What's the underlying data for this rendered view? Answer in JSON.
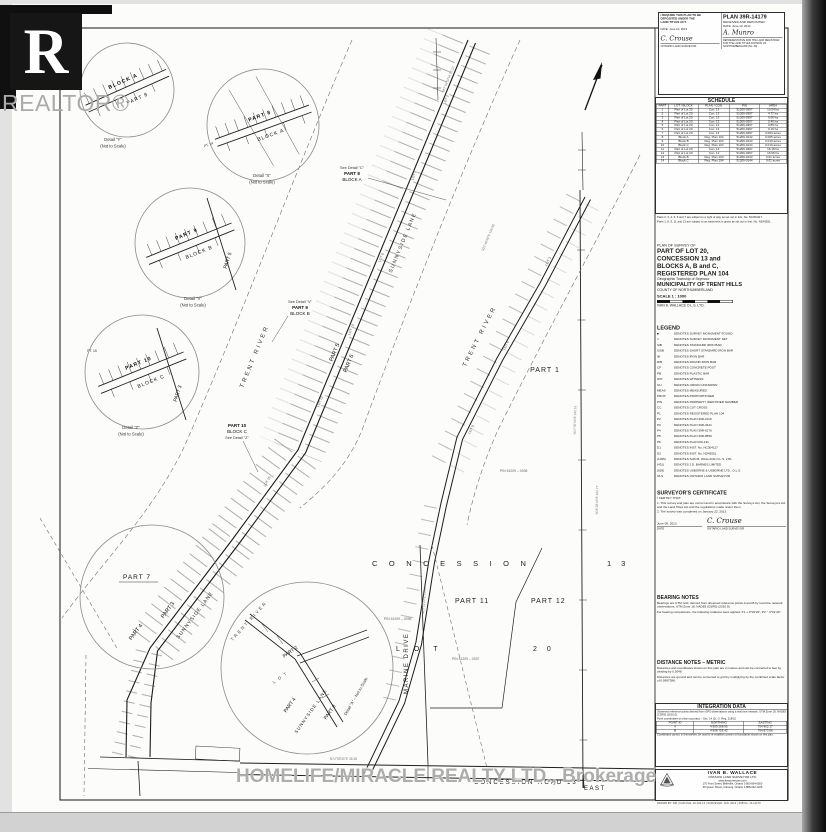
{
  "scan": {
    "realtor_r": "R",
    "realtor_wordmark": "REALTOR®"
  },
  "watermark": {
    "text": "HOMELIFE/MIRACLE REALTY LTD., Brokerage"
  },
  "deposit": {
    "require1": "I REQUIRE THIS PLAN TO BE",
    "require2": "DEPOSITED UNDER THE",
    "require3": "LAND TITLES ACT.",
    "date_left": "DATE:  June 10, 2013",
    "sig_left": "C. Crouse",
    "sig_left_sub": "ONTARIO LAND SURVEYOR",
    "plan_no": "PLAN 39R-14179",
    "received": "RECEIVED AND DEPOSITED",
    "date_right": "DATE:  June 13, 2013",
    "sig_right": "A. Munro",
    "rep_note": "REPRESENTATIVE FOR THE LAND REGISTRAR FOR THE LAND TITLES DIVISION OF NORTHUMBERLAND (No. 39)"
  },
  "schedule": {
    "title": "SCHEDULE",
    "columns": [
      "PART",
      "LOT / BLOCK",
      "PLAN / CON.",
      "PIN",
      "AREA"
    ],
    "rows": [
      {
        "p": "1",
        "lb": "Part of Lot 20",
        "pc": "Con. 13",
        "pin": "51209-0397",
        "a": "10.54 ha"
      },
      {
        "p": "2",
        "lb": "Part of Lot 20",
        "pc": "Con. 13",
        "pin": "51209-0397",
        "a": "4.77 ha"
      },
      {
        "p": "3",
        "lb": "Part of Lot 20",
        "pc": "Con. 13",
        "pin": "51209-0397",
        "a": "0.06 ha"
      },
      {
        "p": "4",
        "lb": "Part of Lot 20",
        "pc": "Con. 13",
        "pin": "51209-0397",
        "a": "0.46 ha"
      },
      {
        "p": "5",
        "lb": "Part of Lot 20",
        "pc": "Con. 13",
        "pin": "51209-0397",
        "a": "0.85 ha"
      },
      {
        "p": "6",
        "lb": "Part of Lot 20",
        "pc": "Con. 13",
        "pin": "51209-0397",
        "a": "0.16 ha"
      },
      {
        "p": "7",
        "lb": "Part of Lot 20",
        "pc": "Con. 13",
        "pin": "51209-0397",
        "a": "0.003 acres"
      },
      {
        "p": "8",
        "lb": "Block A",
        "pc": "Reg. Plan 104",
        "pin": "51209-0142",
        "a": "0.005 acres"
      },
      {
        "p": "9",
        "lb": "Block B",
        "pc": "Reg. Plan 104",
        "pin": "51209-0143",
        "a": "0.019 acres"
      },
      {
        "p": "10",
        "lb": "Block C",
        "pc": "Reg. Plan 104",
        "pin": "51209-0144",
        "a": "0.019 acres"
      },
      {
        "p": "11",
        "lb": "Part of Lot 20",
        "pc": "Con. 13",
        "pin": "51209-0397",
        "a": "16.18 ha"
      },
      {
        "p": "12",
        "lb": "Part of Lot 20",
        "pc": "Con. 13",
        "pin": "51209-0397",
        "a": "16.66 ha"
      },
      {
        "p": "13",
        "lb": "Block B",
        "pc": "Reg. Plan 104",
        "pin": "51209-0143",
        "a": "0.01 acres"
      },
      {
        "p": "14",
        "lb": "Block C",
        "pc": "Reg. Plan 104",
        "pin": "51209-0144",
        "a": "0.01 acres"
      }
    ],
    "note1": "Parts 2, 3, 4, 5, 6 and 7 are subject to a right of way as set out in Inst. No. NC304117.",
    "note2": "Parts 1, 8, 9, 11 and 13 are subject to an easement in gross as set out in Inst. No. ND43551."
  },
  "title_block": {
    "survey_of": "PLAN OF SURVEY OF",
    "line1": "PART OF LOT 20,",
    "line2": "CONCESSION 13 and",
    "line3": "BLOCKS A, B and C,",
    "line4": "REGISTERED PLAN 104",
    "township": "Geographic Township of Seymour",
    "municipality": "MUNICIPALITY OF TRENT HILLS",
    "county": "COUNTY OF NORTHUMBERLAND",
    "scale": "SCALE  1 : 1000",
    "scale_note": "metric",
    "firm": "IVAN B. WALLACE O.L.S. LTD."
  },
  "legend": {
    "title": "LEGEND",
    "entries": [
      {
        "abbr": "■",
        "text": "DENOTES SURVEY MONUMENT FOUND"
      },
      {
        "abbr": "□",
        "text": "DENOTES SURVEY MONUMENT SET"
      },
      {
        "abbr": "SIB",
        "text": "DENOTES STANDARD IRON BAR"
      },
      {
        "abbr": "SSIB",
        "text": "DENOTES SHORT STANDARD IRON BAR"
      },
      {
        "abbr": "IB",
        "text": "DENOTES IRON BAR"
      },
      {
        "abbr": "RIB",
        "text": "DENOTES ROUND IRON BAR"
      },
      {
        "abbr": "CP",
        "text": "DENOTES CONCRETE POST"
      },
      {
        "abbr": "PB",
        "text": "DENOTES PLASTIC BAR"
      },
      {
        "abbr": "WIT",
        "text": "DENOTES WITNESS"
      },
      {
        "abbr": "OU",
        "text": "DENOTES ORIGIN UNKNOWN"
      },
      {
        "abbr": "MEAS",
        "text": "DENOTES MEASURED"
      },
      {
        "abbr": "PROP",
        "text": "DENOTES PROPORTIONED"
      },
      {
        "abbr": "PIN",
        "text": "DENOTES PROPERTY IDENTIFIER NUMBER"
      },
      {
        "abbr": "CC",
        "text": "DENOTES CUT CROSS"
      },
      {
        "abbr": "P1",
        "text": "DENOTES REGISTERED PLAN 104"
      },
      {
        "abbr": "P2",
        "text": "DENOTES PLAN 39R-2119"
      },
      {
        "abbr": "P3",
        "text": "DENOTES PLAN 39R-3441"
      },
      {
        "abbr": "P4",
        "text": "DENOTES PLAN 39R-6176"
      },
      {
        "abbr": "P5",
        "text": "DENOTES PLAN 39R-8556"
      },
      {
        "abbr": "P6",
        "text": "DENOTES PLAN RD-131"
      },
      {
        "abbr": "D1",
        "text": "DENOTES INST. No. NC304117"
      },
      {
        "abbr": "D2",
        "text": "DENOTES INST. No. ND43551"
      },
      {
        "abbr": "(1035)",
        "text": "DENOTES IVAN B. WALLACE O.L.S. LTD."
      },
      {
        "abbr": "(431)",
        "text": "DENOTES J.D. BARNES LIMITED"
      },
      {
        "abbr": "(829)",
        "text": "DENOTES USBORNE & USBORNE LTD., O.L.S."
      },
      {
        "abbr": "OLS",
        "text": "DENOTES ONTARIO LAND SURVEYOR"
      }
    ]
  },
  "certificate": {
    "title": "SURVEYOR'S CERTIFICATE",
    "intro": "I CERTIFY THAT:",
    "item1": "1.  This survey and plan are correct and in accordance with the Surveys Act, the Surveyors Act and the Land Titles Act and the regulations made under them.",
    "item2": "2.  The survey was completed on January 22, 2013.",
    "date": "June 09, 2013",
    "date_sub": "DATE",
    "sig": "C. Crouse",
    "sig_sub": "ONTARIO LAND SURVEYOR"
  },
  "bearing_notes": {
    "title": "BEARING NOTES",
    "p1": "Bearings are UTM Grid, derived from observed reference points A and B by real time network observations, UTM Zone 18, NAD83 (CSRS) (2010.0).",
    "p2": "For bearing comparisons, the following rotations were applied:  P1 + 0°02'20\",  P2 − 0°01'40\"."
  },
  "distance_notes": {
    "title": "DISTANCE NOTES  –  METRIC",
    "p1": "Distances and coordinates shown on this plan are in metres and can be converted to feet by dividing by 0.3048.",
    "p2": "Distances are ground and can be converted to grid by multiplying by the combined scale factor of 0.9997398."
  },
  "integration": {
    "title": "INTEGRATION DATA",
    "note": "Observed reference points derived from GPS observations using a real time network, UTM Zone 18, NAD83 (CSRS) (2010.0).",
    "sub": "Point coordinates to urban accuracy – Sec. 14 (2), O. Reg. 216/10",
    "columns": [
      "POINT ID",
      "NORTHING",
      "EASTING"
    ],
    "rows": [
      {
        "id": "A",
        "n": "4 909 268.95",
        "e": "754 962.17"
      },
      {
        "id": "B",
        "n": "4 908 755.42",
        "e": "754 873.66"
      }
    ],
    "footnote": "Coordinates cannot, in themselves, be used to re-establish corners or boundaries shown on this plan."
  },
  "firm_box": {
    "name": "IVAN B. WALLACE",
    "name2": "ONTARIO LAND SURVEYOR LTD.",
    "web": "www.ibwsurveyors.com",
    "addr1": "170 Front Street, Belleville, Ontario   1-800-954-6500",
    "addr2": "39 Queen Street, Cobourg, Ontario   1-888-342-1226",
    "file_line": "DRAWN BY: DM   |   CAD FILE: 20-104-13   |   SURVEYED: JAN. 2013   |   JOB No. 13-14179"
  },
  "map": {
    "concession": "CONCESSION",
    "thirteen": "13",
    "part1": "PART 1",
    "part11": "PART 11",
    "part12": "PART 12",
    "lot": "LOT",
    "twenty": "20",
    "marine_drive": "MARINE DRIVE",
    "road": "CONCESSION    ROAD    13",
    "east": "EAST",
    "trent_river": "TRENT RIVER",
    "sunnyside_lane": "SUNNYSIDE LANE",
    "part2": "PART 2",
    "part3": "PART 3",
    "part4": "PART 4",
    "part5": "PART 5",
    "part6": "PART 6",
    "part7": "PART 7",
    "part8": "PART 8",
    "part9": "PART 9",
    "part10": "PART 10",
    "block_a": "BLOCK A",
    "block_b": "BLOCK B",
    "block_c": "BLOCK C",
    "see_detail_c": "See Detail \"C\"",
    "see_detail_v": "See Detail \"V\"",
    "see_detail_z": "See Detail \"Z\"",
    "detail_y": "Detail \"Y\"",
    "detail_x": "Detail \"X\"",
    "detail_v": "Detail \"V\"",
    "detail_z": "Detail \"Z\"",
    "detail_a": "Detail \"A\" – Not to Scale",
    "nts": "(Not to Scale)",
    "pt14": "PT. 14",
    "pt15": "PT. 15",
    "pin_a": "PIN 51209 – 0398",
    "pin_b": "PIN 51209 – 0397",
    "pin_c": "PIN 51209 – 0396",
    "lots": {
      "l1": "LOT 2",
      "l2": "LOT 5",
      "l3": "LOT 8",
      "l4": "LOT 10",
      "l5": "LOT 12",
      "l6": "LOT 15",
      "l7": "LOT 3",
      "l8": "LOT 6",
      "l9": "LOT 9"
    },
    "dims": {
      "b1": "N22°40'50\"E  156.08",
      "b2": "N17°05'30\"E  242.51",
      "b3": "N23°11'20\"E  310.44",
      "b4": "N67°44'10\"W  20.12",
      "b5": "N72°59'30\"E  35.38",
      "b6": "N16°28'40\"E  402.77"
    }
  }
}
